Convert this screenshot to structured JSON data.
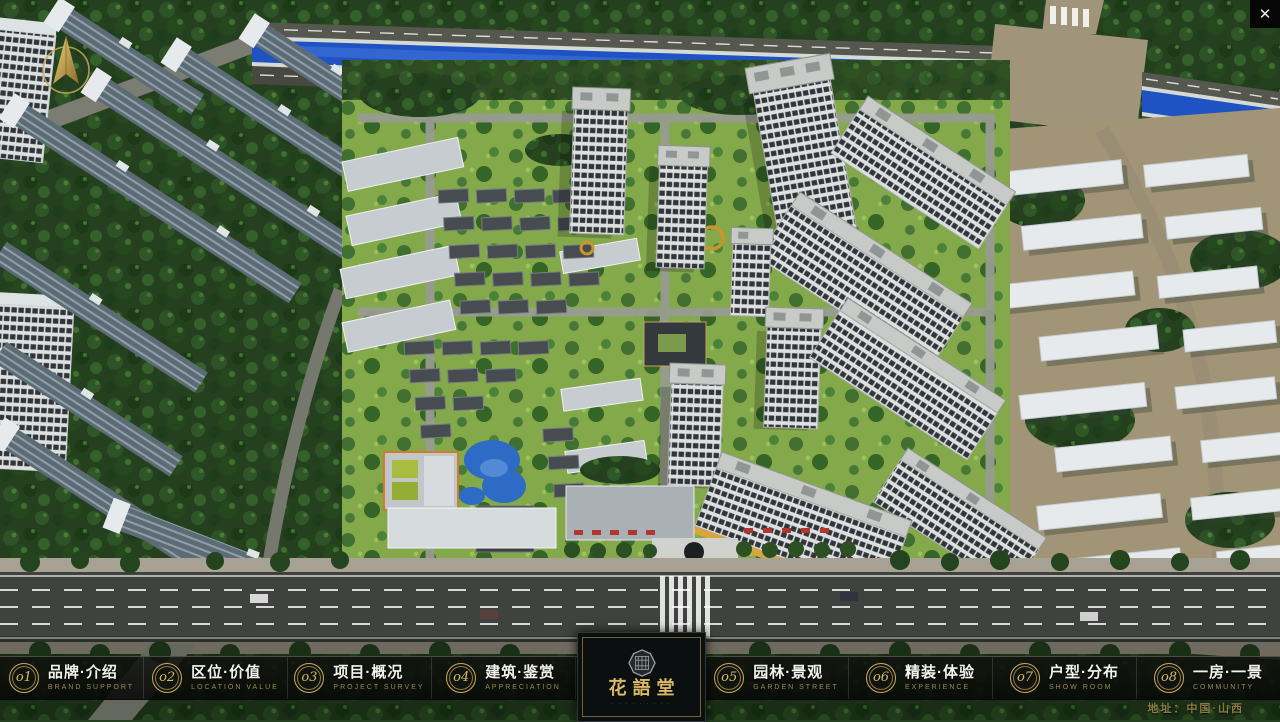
{
  "app": {
    "close_glyph": "✕"
  },
  "nav": {
    "items": [
      {
        "num": "o1",
        "label": "品牌·介绍",
        "sub": "BRAND SUPPORT"
      },
      {
        "num": "o2",
        "label": "区位·价值",
        "sub": "LOCATION VALUE"
      },
      {
        "num": "o3",
        "label": "项目·概况",
        "sub": "PROJECT SURVEY"
      },
      {
        "num": "o4",
        "label": "建筑·鉴赏",
        "sub": "APPRECIATION"
      },
      {
        "num": "o5",
        "label": "园林·景观",
        "sub": "GARDEN STREET"
      },
      {
        "num": "o6",
        "label": "精装·体验",
        "sub": "EXPERIENCE"
      },
      {
        "num": "o7",
        "label": "户型·分布",
        "sub": "SHOW ROOM"
      },
      {
        "num": "o8",
        "label": "一房·一景",
        "sub": "COMMUNITY"
      }
    ]
  },
  "logo": {
    "title": "花語堂",
    "subtitle": "· · · · · · · · ·"
  },
  "footer": {
    "address": "地址：中国·山西"
  },
  "colors": {
    "accent_gold": "#c8a95e",
    "bar_background": "#0b0d0b",
    "river_blue": "#1f52c2",
    "address_gold": "#8b7c43"
  }
}
